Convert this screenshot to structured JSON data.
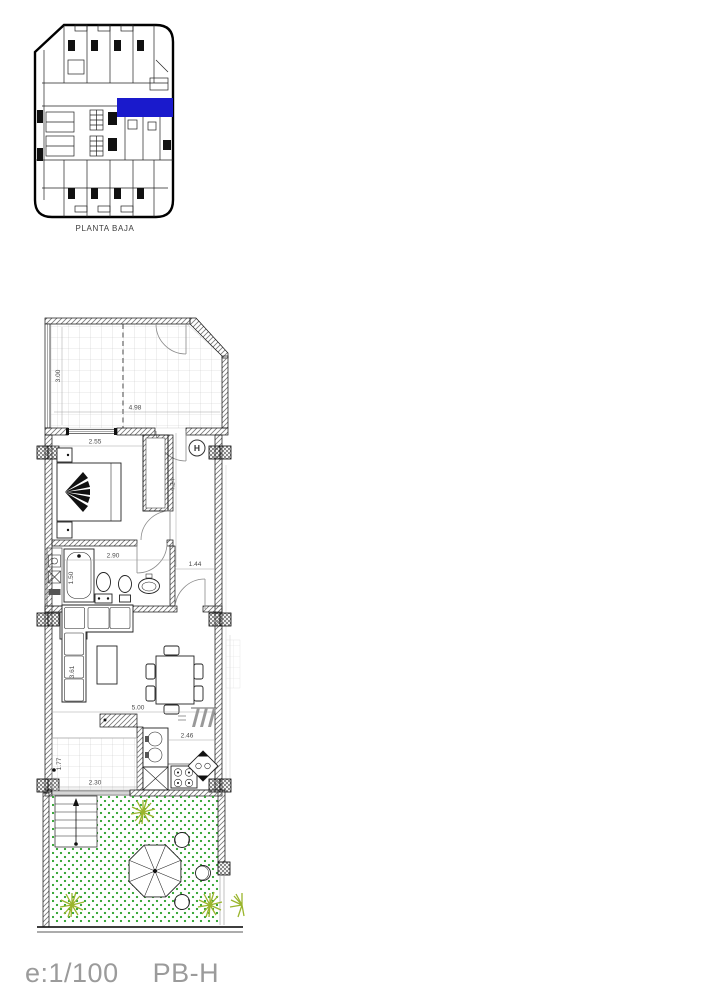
{
  "key_plan": {
    "caption": "PLANTA BAJA",
    "highlight_color": "#1a1acc"
  },
  "plan": {
    "hall_label": "H",
    "dims": {
      "terrace_depth": "3.00",
      "terrace_width": "4.98",
      "bedroom_width": "2.55",
      "hall_length": "4.24",
      "bathroom_width": "2.90",
      "bathroom_depth": "1.50",
      "corridor_width": "1.44",
      "living_depth": "3.61",
      "living_width": "5.00",
      "kitchen_width": "2.46",
      "patio_depth": "1.77",
      "patio_width": "2.30"
    }
  },
  "footer": {
    "scale": "e:1/100",
    "plan_code": "PB-H"
  },
  "colors": {
    "highlight_blue": "#1a1acc",
    "grass_green": "#2ea32e",
    "plant_green": "#9ab52c",
    "tile_gray": "#cccccc",
    "footer_gray": "#9b9b9b"
  }
}
